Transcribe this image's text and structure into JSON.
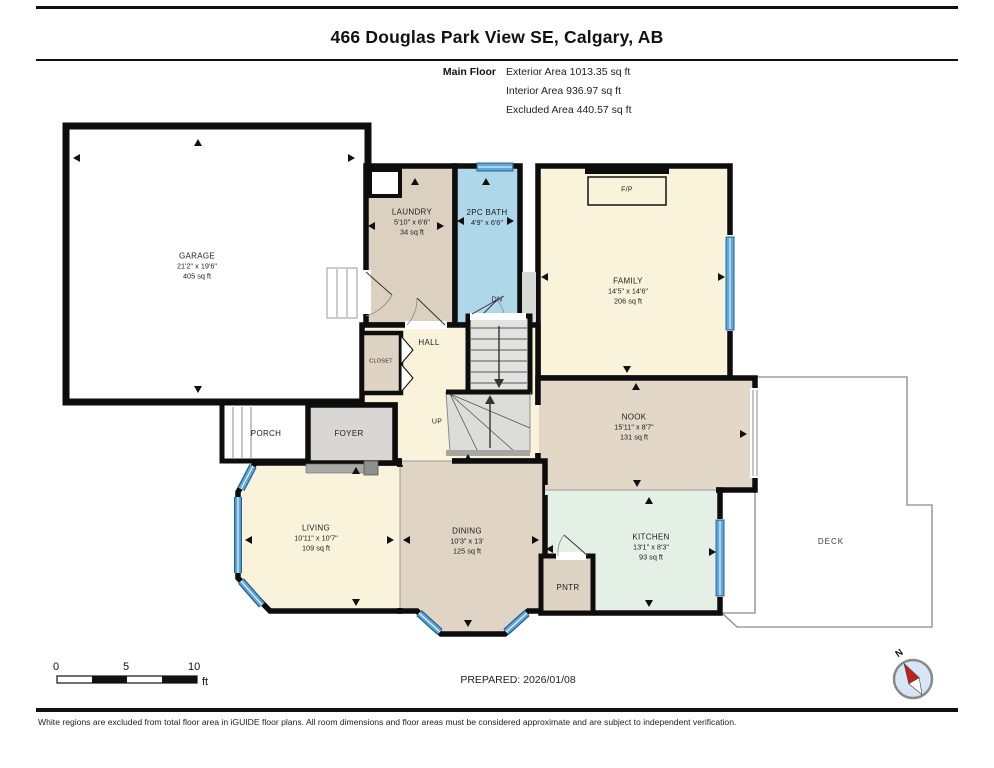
{
  "header": {
    "title": "466 Douglas Park View SE, Calgary, AB",
    "floor_label": "Main Floor",
    "stats": [
      "Exterior Area 1013.35 sq ft",
      "Interior Area 936.97 sq ft",
      "Excluded Area 440.57 sq ft"
    ]
  },
  "rooms": {
    "garage": {
      "name": "GARAGE",
      "dims": "21'2\" x 19'6\"",
      "area": "405 sq ft"
    },
    "laundry": {
      "name": "LAUNDRY",
      "dims": "5'10\" x 6'6\"",
      "area": "34 sq ft"
    },
    "bath": {
      "name": "2PC BATH",
      "dims": "4'9\" x 6'6\"",
      "area": ""
    },
    "family": {
      "name": "FAMILY",
      "dims": "14'5\" x 14'6\"",
      "area": "206 sq ft"
    },
    "hall": {
      "name": "HALL"
    },
    "closet": {
      "name": "CLOSET"
    },
    "foyer": {
      "name": "FOYER"
    },
    "porch": {
      "name": "PORCH"
    },
    "nook": {
      "name": "NOOK",
      "dims": "15'11\" x 8'7\"",
      "area": "131 sq ft"
    },
    "living": {
      "name": "LIVING",
      "dims": "10'11\" x 10'7\"",
      "area": "109 sq ft"
    },
    "dining": {
      "name": "DINING",
      "dims": "10'3\" x 13'",
      "area": "125 sq ft"
    },
    "kitchen": {
      "name": "KITCHEN",
      "dims": "13'1\" x 8'3\"",
      "area": "93 sq ft"
    },
    "pantry": {
      "name": "PNTR"
    },
    "deck": {
      "name": "DECK"
    }
  },
  "annotations": {
    "fireplace": "F/P",
    "stairs_down": "DN",
    "stairs_up": "UP"
  },
  "scale_bar": {
    "tick0": "0",
    "tick1": "5",
    "tick2": "10",
    "unit": "ft"
  },
  "compass": {
    "north_label": "N"
  },
  "footer": {
    "prepared": "PREPARED: 2026/01/08",
    "disclaimer": "White regions are excluded from total floor area in iGUIDE floor plans. All room dimensions and floor areas must be considered approximate and are subject to independent verification."
  },
  "colors": {
    "wall": "#0d0d0d",
    "window_blue": "#5EA7D8",
    "window_edge": "#2a608f",
    "cream": "#FAF3DC",
    "tan": "#E0D5C5",
    "bath_blue": "#AFD7EA",
    "kitchen_mint": "#E4EFE6",
    "foyer_gray": "#D8D7D3",
    "stair_gray": "#E0E0DC"
  }
}
